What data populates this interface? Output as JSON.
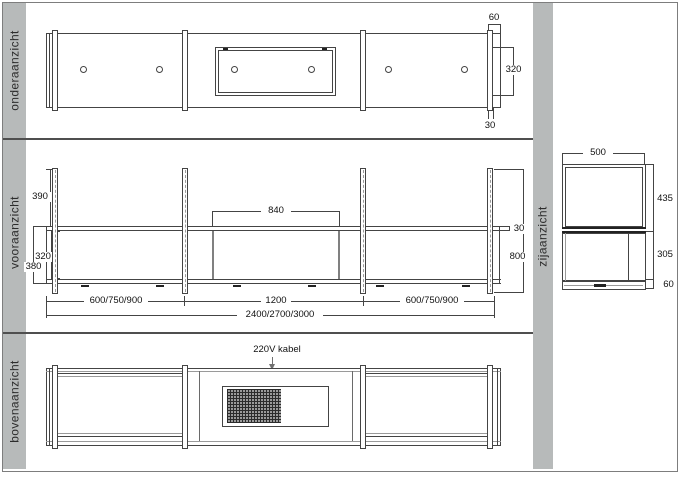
{
  "views": {
    "bottom": {
      "label": "onderaanzicht",
      "dims": {
        "end_width": "60",
        "depth": "320",
        "post_width": "30"
      }
    },
    "front": {
      "label": "vooraanzicht",
      "dims": {
        "post_height": "390",
        "box_width": "840",
        "inner_height": "320",
        "outer_height": "380",
        "shelf_thickness": "30",
        "total_height": "800",
        "left_section": "600/750/900",
        "mid_section": "1200",
        "right_section": "600/750/900",
        "total_width": "2400/2700/3000"
      }
    },
    "top": {
      "label": "bovenaanzicht",
      "cable_note": "220V kabel"
    },
    "side": {
      "label": "zijaanzicht",
      "dims": {
        "width": "500",
        "upper_height": "435",
        "lower_height": "305",
        "base_height": "60"
      }
    }
  },
  "colors": {
    "strip_gray": "#b7baba",
    "line": "#444444",
    "accent_gray": "#9a9a9a"
  }
}
